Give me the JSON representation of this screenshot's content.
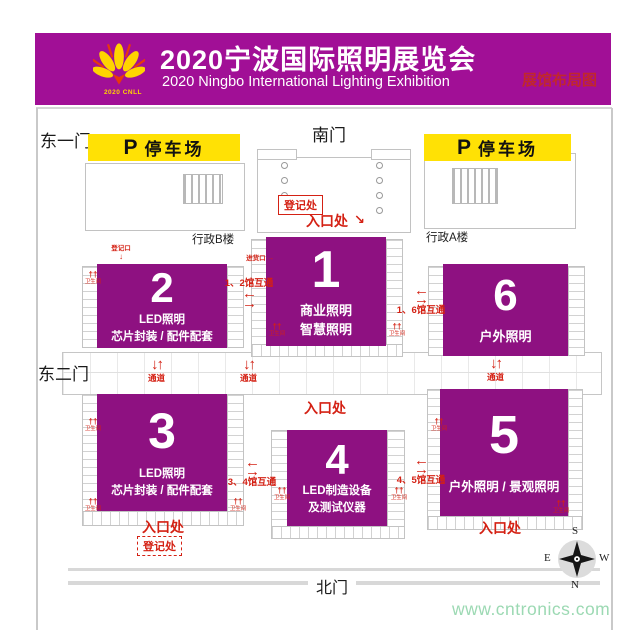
{
  "header": {
    "title": "2020宁波国际照明展览会",
    "subtitle": "2020 Ningbo International Lighting Exhibition",
    "tagline": "展馆布局图",
    "logo_text": "2020 CNLL"
  },
  "gates": {
    "east1": "东一门",
    "south": "南门",
    "east2": "东二门",
    "north": "北门"
  },
  "parking": {
    "p": "P",
    "label": "停车场"
  },
  "buildings": {
    "admin_b": "行政B楼",
    "admin_a": "行政A楼"
  },
  "halls": [
    {
      "num": "1",
      "line1": "商业照明",
      "line2": "智慧照明"
    },
    {
      "num": "2",
      "line1": "LED照明",
      "line2": "芯片封装 / 配件配套"
    },
    {
      "num": "3",
      "line1": "LED照明",
      "line2": "芯片封装 / 配件配套"
    },
    {
      "num": "4",
      "line1": "LED制造设备",
      "line2": "及测试仪器"
    },
    {
      "num": "5",
      "line1": "户外照明 / 景观照明"
    },
    {
      "num": "6",
      "line1": "户外照明"
    }
  ],
  "labels": {
    "entrance": "入口处",
    "registration": "登记处",
    "passage": "通道",
    "link_1_2": "1、2馆互通",
    "link_1_6": "1、6馆互通",
    "link_3_4": "3、4馆互通",
    "link_4_5": "4、5馆互通",
    "toilet": "卫生间",
    "reg_door": "登记口",
    "goods_door": "进货口"
  },
  "compass": {
    "s": "S",
    "e": "E",
    "w": "W",
    "n": "N"
  },
  "icons": {
    "arrow_left": "←",
    "arrow_right": "→",
    "arrow_up": "↑",
    "arrow_down": "↓",
    "arrow_se": "↘",
    "toilet_icon": "††"
  },
  "watermark": "www.cntronics.com",
  "colors": {
    "banner_magenta": "#A10F96",
    "hall_purple": "#8E1181",
    "accent_red": "#D42114",
    "parking_yellow": "#FFE105",
    "tagline_red": "#C1272D",
    "watermark_green": "#9CD9B3"
  }
}
